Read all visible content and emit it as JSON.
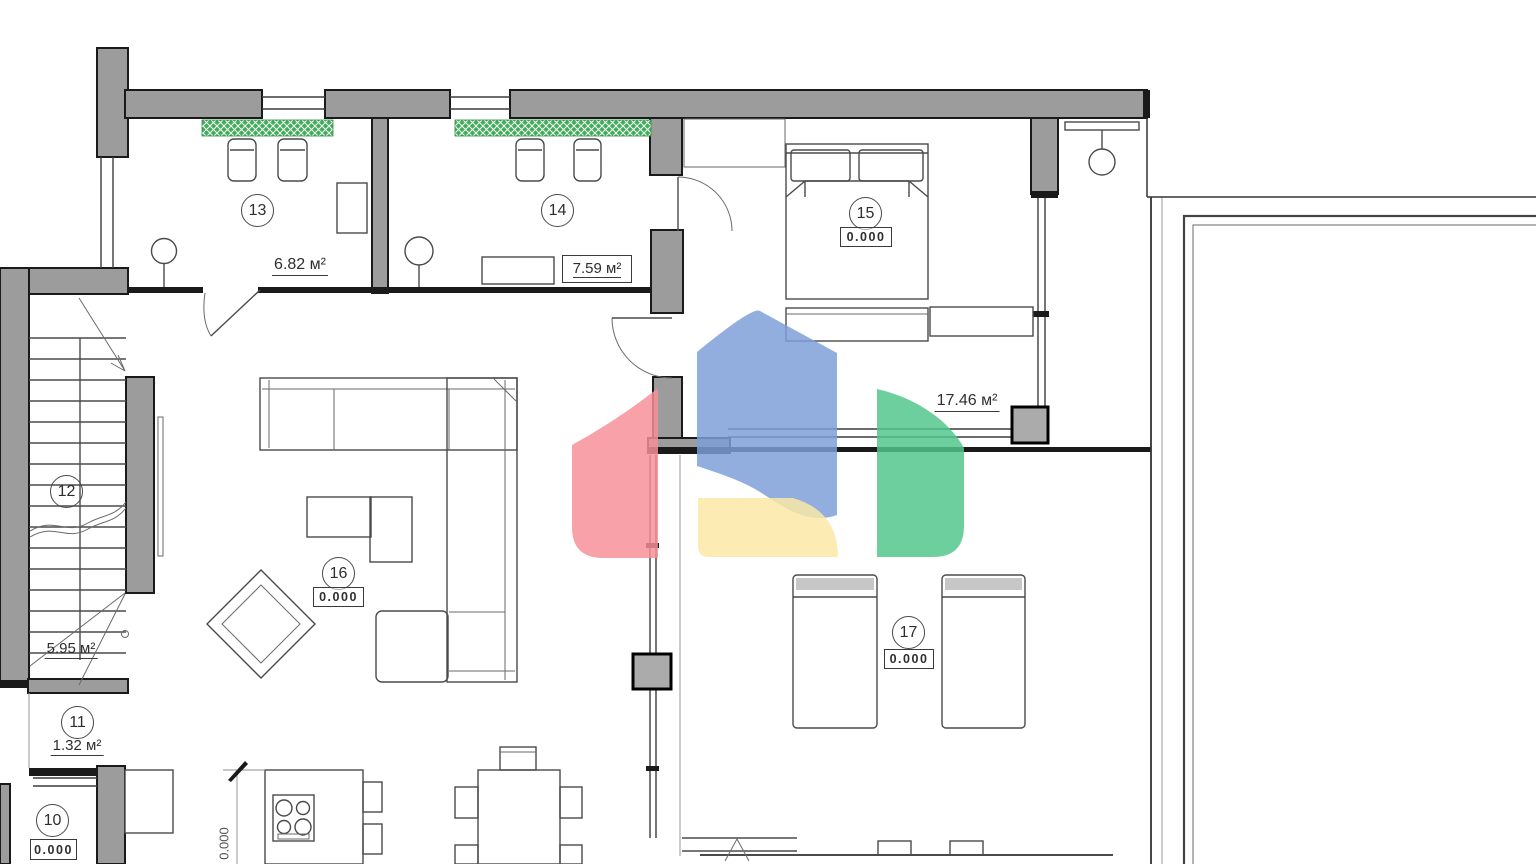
{
  "document": {
    "type": "architectural floor plan",
    "language": "ru"
  },
  "rooms": [
    {
      "id": "10",
      "label": "10",
      "value": "0.000",
      "value_type": "elevation"
    },
    {
      "id": "11",
      "label": "11",
      "value": "1.32 м²",
      "value_type": "area"
    },
    {
      "id": "12",
      "label": "12",
      "value": "5.95 м²",
      "value_type": "area"
    },
    {
      "id": "13",
      "label": "13",
      "value": "6.82 м²",
      "value_type": "area"
    },
    {
      "id": "14",
      "label": "14",
      "value": "7.59 м²",
      "value_type": "area"
    },
    {
      "id": "15",
      "label": "15",
      "value": "0.000",
      "value_type": "elevation"
    },
    {
      "id": "16",
      "label": "16",
      "value": "0.000",
      "value_type": "elevation"
    },
    {
      "id": "17",
      "label": "17",
      "value": "0.000",
      "value_type": "elevation"
    }
  ],
  "annotations": {
    "zone_area": "17.46 м²",
    "floor_level": "0.000"
  },
  "palette": {
    "paper": "#ffffff",
    "wall_fill": "#9c9c9c",
    "wall_edge": "#1a1a1a",
    "line": "#4a4a4a",
    "hatch_green": "#3fae58"
  },
  "watermark": {
    "description": "house-logo-watermark",
    "colors": {
      "blue": "#7d9ed8",
      "red": "#f88f99",
      "yellow": "#fbe8a6",
      "green": "#52c68c"
    }
  }
}
